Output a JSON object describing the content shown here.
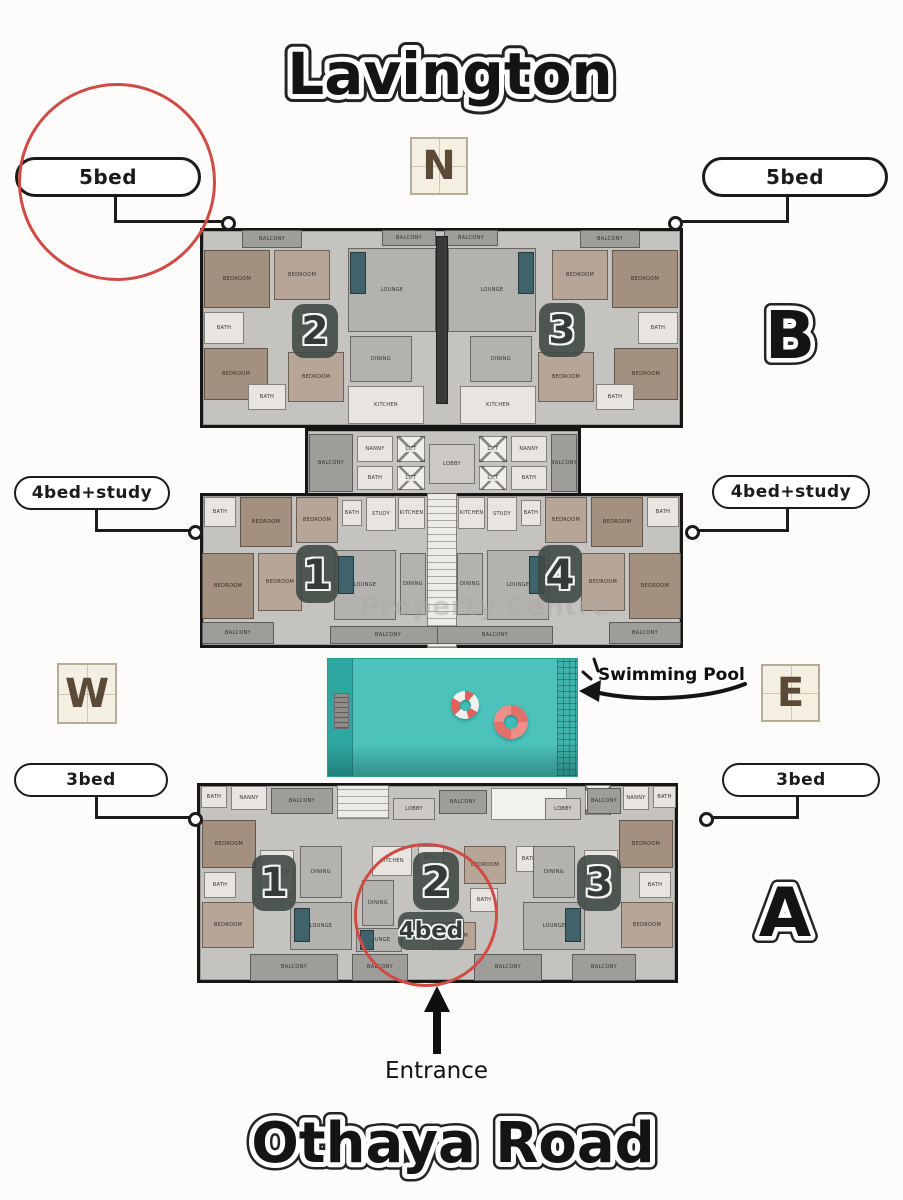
{
  "titles": {
    "project": "Lavington",
    "road": "Othaya Road"
  },
  "compass": {
    "north": "N",
    "west": "W",
    "east": "E"
  },
  "block_letters": {
    "b": "B",
    "a": "A"
  },
  "unit_tags": {
    "top_left": "5bed",
    "top_right": "5bed",
    "mid_left": "4bed+study",
    "mid_right": "4bed+study",
    "bottom_left": "3bed",
    "bottom_right": "3bed",
    "circled_unit": "4bed"
  },
  "annotations": {
    "pool": "Swimming Pool",
    "entrance": "Entrance",
    "watermark": "Property Centre"
  },
  "colors": {
    "highlight_red": "#d04b43",
    "pool_teal": "#4cc2bb",
    "compass_cream": "#f4efe1",
    "badge_slate": "#404a46"
  },
  "floorplan": {
    "buildings": [
      {
        "name": "block-b-main",
        "x": 200,
        "y": 228,
        "w": 483,
        "h": 200,
        "rooms": [
          [
            "BALCONY",
            242,
            230,
            60,
            18,
            "balc"
          ],
          [
            "BEDROOM",
            204,
            250,
            66,
            58,
            "wood"
          ],
          [
            "BEDROOM",
            274,
            250,
            56,
            50,
            "woodlight"
          ],
          [
            "BATH",
            204,
            312,
            40,
            32,
            "light"
          ],
          [
            "BEDROOM",
            204,
            348,
            64,
            52,
            "wood"
          ],
          [
            "BATH",
            248,
            384,
            38,
            26,
            "light"
          ],
          [
            "BEDROOM",
            288,
            352,
            56,
            50,
            "woodlight"
          ],
          [
            "BALCONY",
            382,
            230,
            54,
            16,
            "balc"
          ],
          [
            "BALCONY",
            444,
            230,
            54,
            16,
            "balc"
          ],
          [
            "LOUNGE",
            348,
            248,
            88,
            84,
            "gray"
          ],
          [
            "",
            350,
            252,
            16,
            42,
            "accent"
          ],
          [
            "DINING",
            350,
            336,
            62,
            46,
            "gray"
          ],
          [
            "KITCHEN",
            348,
            386,
            76,
            38,
            "light"
          ],
          [
            "",
            436,
            236,
            12,
            168,
            "dark"
          ],
          [
            "LOUNGE",
            448,
            248,
            88,
            84,
            "gray"
          ],
          [
            "",
            518,
            252,
            16,
            42,
            "accent"
          ],
          [
            "DINING",
            470,
            336,
            62,
            46,
            "gray"
          ],
          [
            "KITCHEN",
            460,
            386,
            76,
            38,
            "light"
          ],
          [
            "BALCONY",
            580,
            230,
            60,
            18,
            "balc"
          ],
          [
            "BEDROOM",
            552,
            250,
            56,
            50,
            "woodlight"
          ],
          [
            "BEDROOM",
            612,
            250,
            66,
            58,
            "wood"
          ],
          [
            "BATH",
            638,
            312,
            40,
            32,
            "light"
          ],
          [
            "BEDROOM",
            614,
            348,
            64,
            52,
            "wood"
          ],
          [
            "BATH",
            596,
            384,
            38,
            26,
            "light"
          ],
          [
            "BEDROOM",
            538,
            352,
            56,
            50,
            "woodlight"
          ]
        ]
      },
      {
        "name": "block-b-core",
        "x": 305,
        "y": 428,
        "w": 276,
        "h": 70,
        "rooms": [
          [
            "BALCONY",
            309,
            434,
            44,
            58,
            "balc"
          ],
          [
            "NANNY",
            357,
            436,
            36,
            26,
            "light"
          ],
          [
            "BATH",
            357,
            466,
            36,
            24,
            "light"
          ],
          [
            "LIFT",
            397,
            436,
            28,
            26,
            "lift"
          ],
          [
            "LIFT",
            397,
            466,
            28,
            24,
            "lift"
          ],
          [
            "LOBBY",
            429,
            444,
            46,
            40,
            "graylight"
          ],
          [
            "LIFT",
            479,
            436,
            28,
            26,
            "lift"
          ],
          [
            "LIFT",
            479,
            466,
            28,
            24,
            "lift"
          ],
          [
            "NANNY",
            511,
            436,
            36,
            26,
            "light"
          ],
          [
            "BATH",
            511,
            466,
            36,
            24,
            "light"
          ],
          [
            "BALCONY",
            551,
            434,
            26,
            58,
            "balc"
          ]
        ]
      },
      {
        "name": "block-mid",
        "x": 200,
        "y": 493,
        "w": 483,
        "h": 155,
        "rooms": [
          [
            "BATH",
            204,
            497,
            32,
            30,
            "light"
          ],
          [
            "BEDROOM",
            240,
            497,
            52,
            50,
            "wood"
          ],
          [
            "BEDROOM",
            296,
            497,
            42,
            46,
            "woodlight"
          ],
          [
            "BATH",
            342,
            500,
            20,
            26,
            "light"
          ],
          [
            "STUDY",
            366,
            497,
            30,
            34,
            "light"
          ],
          [
            "KITCHEN",
            398,
            497,
            27,
            32,
            "light"
          ],
          [
            "",
            427,
            493,
            30,
            155,
            "stair"
          ],
          [
            "KITCHEN",
            458,
            497,
            27,
            32,
            "light"
          ],
          [
            "STUDY",
            487,
            497,
            30,
            34,
            "light"
          ],
          [
            "BATH",
            521,
            500,
            20,
            26,
            "light"
          ],
          [
            "BEDROOM",
            545,
            497,
            42,
            46,
            "woodlight"
          ],
          [
            "BEDROOM",
            591,
            497,
            52,
            50,
            "wood"
          ],
          [
            "BATH",
            647,
            497,
            32,
            30,
            "light"
          ],
          [
            "BEDROOM",
            202,
            553,
            52,
            66,
            "wood"
          ],
          [
            "BEDROOM",
            258,
            553,
            44,
            58,
            "woodlight"
          ],
          [
            "LOUNGE",
            334,
            550,
            62,
            70,
            "gray"
          ],
          [
            "",
            338,
            556,
            16,
            38,
            "accent"
          ],
          [
            "DINING",
            400,
            553,
            26,
            62,
            "gray"
          ],
          [
            "DINING",
            457,
            553,
            26,
            62,
            "gray"
          ],
          [
            "LOUNGE",
            487,
            550,
            62,
            70,
            "gray"
          ],
          [
            "",
            529,
            556,
            16,
            38,
            "accent"
          ],
          [
            "BEDROOM",
            581,
            553,
            44,
            58,
            "woodlight"
          ],
          [
            "BEDROOM",
            629,
            553,
            52,
            66,
            "wood"
          ],
          [
            "BALCONY",
            202,
            622,
            72,
            22,
            "balc"
          ],
          [
            "BALCONY",
            330,
            626,
            116,
            18,
            "balc"
          ],
          [
            "BALCONY",
            437,
            626,
            116,
            18,
            "balc"
          ],
          [
            "BALCONY",
            609,
            622,
            72,
            22,
            "balc"
          ]
        ]
      },
      {
        "name": "block-a",
        "x": 197,
        "y": 783,
        "w": 481,
        "h": 200,
        "rooms": [
          [
            "BATH",
            201,
            786,
            26,
            22,
            "light"
          ],
          [
            "NANNY",
            231,
            786,
            36,
            24,
            "light"
          ],
          [
            "BALCONY",
            271,
            788,
            62,
            26,
            "balc"
          ],
          [
            "",
            337,
            785,
            52,
            34,
            "stair"
          ],
          [
            "LOBBY",
            393,
            798,
            42,
            22,
            "graylight"
          ],
          [
            "BALCONY",
            439,
            790,
            48,
            24,
            "balc"
          ],
          [
            "",
            491,
            788,
            76,
            32,
            "ramp"
          ],
          [
            "LOBBY",
            545,
            798,
            36,
            22,
            "graylight"
          ],
          [
            "",
            585,
            785,
            26,
            30,
            "lift"
          ],
          [
            "BALCONY",
            587,
            788,
            34,
            26,
            "balc"
          ],
          [
            "NANNY",
            623,
            786,
            26,
            24,
            "light"
          ],
          [
            "BATH",
            653,
            786,
            23,
            22,
            "light"
          ],
          [
            "BEDROOM",
            202,
            820,
            54,
            48,
            "wood"
          ],
          [
            "BATH",
            204,
            872,
            32,
            26,
            "light"
          ],
          [
            "BEDROOM",
            202,
            902,
            52,
            46,
            "woodlight"
          ],
          [
            "KITCHEN",
            260,
            850,
            34,
            44,
            "light"
          ],
          [
            "DINING",
            300,
            846,
            42,
            52,
            "gray"
          ],
          [
            "LOUNGE",
            290,
            902,
            62,
            48,
            "gray"
          ],
          [
            "",
            294,
            908,
            16,
            34,
            "accent"
          ],
          [
            "KITCHEN",
            372,
            846,
            40,
            30,
            "light"
          ],
          [
            "BATH",
            418,
            846,
            26,
            24,
            "light"
          ],
          [
            "DINING",
            362,
            880,
            32,
            46,
            "gray"
          ],
          [
            "BEDROOM",
            464,
            846,
            42,
            38,
            "woodlight"
          ],
          [
            "BATH",
            470,
            888,
            28,
            24,
            "light"
          ],
          [
            "BEDROOM",
            432,
            922,
            44,
            28,
            "woodlight"
          ],
          [
            "LOUNGE",
            356,
            928,
            46,
            24,
            "gray"
          ],
          [
            "",
            360,
            930,
            14,
            20,
            "accent"
          ],
          [
            "BATH",
            516,
            846,
            26,
            26,
            "light"
          ],
          [
            "DINING",
            533,
            846,
            42,
            52,
            "gray"
          ],
          [
            "KITCHEN",
            584,
            850,
            34,
            40,
            "light"
          ],
          [
            "LOUNGE",
            523,
            902,
            62,
            48,
            "gray"
          ],
          [
            "",
            565,
            908,
            16,
            34,
            "accent"
          ],
          [
            "BEDROOM",
            619,
            820,
            54,
            48,
            "wood"
          ],
          [
            "BATH",
            639,
            872,
            32,
            26,
            "light"
          ],
          [
            "BEDROOM",
            621,
            902,
            52,
            46,
            "woodlight"
          ],
          [
            "BALCONY",
            250,
            954,
            88,
            27,
            "balc"
          ],
          [
            "BALCONY",
            352,
            954,
            56,
            27,
            "balc"
          ],
          [
            "BALCONY",
            474,
            954,
            68,
            27,
            "balc"
          ],
          [
            "BALCONY",
            572,
            954,
            64,
            27,
            "balc"
          ]
        ]
      }
    ],
    "badges": [
      {
        "n": "2",
        "x": 292,
        "y": 304,
        "w": 46,
        "h": 54
      },
      {
        "n": "3",
        "x": 539,
        "y": 303,
        "w": 46,
        "h": 54
      },
      {
        "n": "1",
        "x": 296,
        "y": 545,
        "w": 42,
        "h": 58
      },
      {
        "n": "4",
        "x": 538,
        "y": 545,
        "w": 44,
        "h": 58
      },
      {
        "n": "1",
        "x": 252,
        "y": 855,
        "w": 44,
        "h": 56
      },
      {
        "n": "2",
        "x": 413,
        "y": 852,
        "w": 46,
        "h": 58
      },
      {
        "n": "3",
        "x": 577,
        "y": 855,
        "w": 44,
        "h": 56
      }
    ]
  }
}
